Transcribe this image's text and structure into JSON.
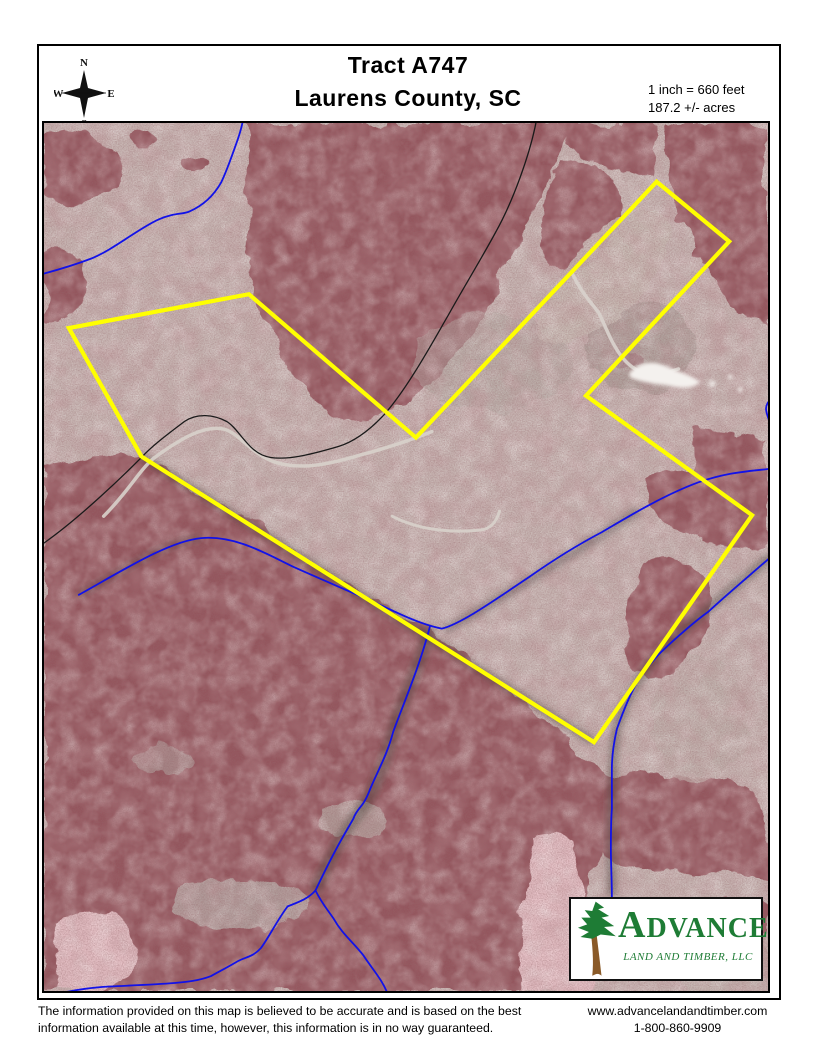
{
  "header": {
    "title_line1": "Tract A747",
    "title_line2": "Laurens County, SC",
    "scale_text": "1 inch = 660 feet",
    "acreage_text": "187.2 +/- acres",
    "compass": {
      "north": "N",
      "south": "S",
      "east": "E",
      "west": "W"
    }
  },
  "map": {
    "colors": {
      "boundary": "#ffff00",
      "stream": "#1212e8",
      "road": "#1a1a1a",
      "logo_green": "#1e7c35",
      "logo_trunk": "#8a5a28"
    }
  },
  "logo": {
    "name": "ADVANCE",
    "subtitle": "LAND AND TIMBER, LLC"
  },
  "footer": {
    "disclaimer_line1": "The information provided on this map is believed to be accurate and is based on the best",
    "disclaimer_line2": "information available at this time, however, this information is in no way guaranteed.",
    "website": "www.advancelandandtimber.com",
    "phone": "1-800-860-9909"
  }
}
